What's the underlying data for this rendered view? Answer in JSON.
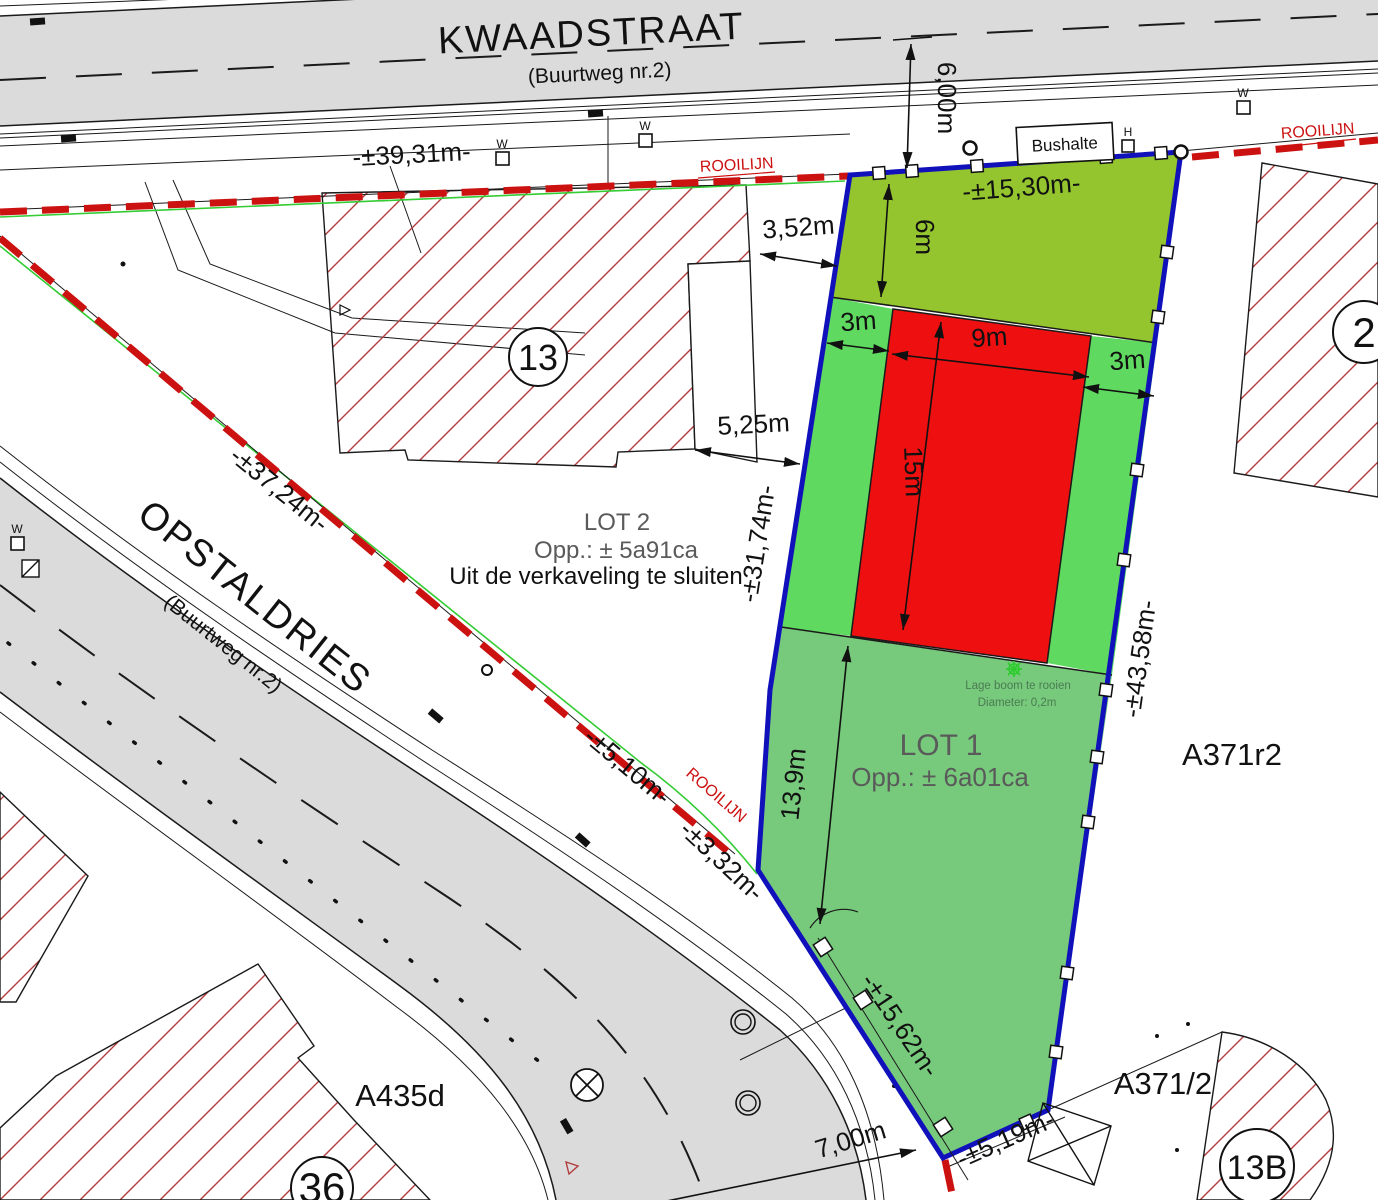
{
  "streets": {
    "kwaadstraat": {
      "name": "KWAADSTRAAT",
      "subtitle": "(Buurtweg nr.2)"
    },
    "opstaldries": {
      "name": "OPSTALDRIES",
      "subtitle": "(Buurtweg nr.2)"
    }
  },
  "lots": {
    "lot1": {
      "title": "LOT 1",
      "area": "Opp.: ± 6a01ca"
    },
    "lot2": {
      "title": "LOT 2",
      "area": "Opp.: ± 5a91ca",
      "note": "Uit de verkaveling te sluiten"
    }
  },
  "dims": {
    "road_top": "6,00m",
    "top_length": "-±39,31m-",
    "front": "-±15,30m-",
    "front_depth": "6m",
    "side_left": "3m",
    "zone_width": "9m",
    "side_right": "3m",
    "zone_depth": "15m",
    "gap_top": "3,52m",
    "gap_mid": "5,25m",
    "left_edge": "-±31,74m-",
    "right_edge": "-±43,58m-",
    "diag_length": "-±37,24m-",
    "seg_a": "-±5,10m-",
    "seg_b": "-±3,32m-",
    "lot1_depth": "13,9m",
    "lower_left": "-±15,62m-",
    "bottom_edge": "-±5,19m-",
    "road_bottom": "7,00m"
  },
  "labels": {
    "rooilijn": "ROOILIJN",
    "bushalte": "Bushalte",
    "w_marker": "W",
    "h_marker": "H"
  },
  "tree": {
    "line1": "Lage boom te rooien",
    "line2": "Diameter: 0,2m"
  },
  "parcels": {
    "house13": "13",
    "house2": "2",
    "house36": "36",
    "house13b": "13B",
    "a371r2": "A371r2",
    "a371_2": "A371/2",
    "a435d": "A435d"
  },
  "colors": {
    "road_gray": "#dbdbdb",
    "rooilijn_red": "#cc1111",
    "rooilijn_green": "#33cc33",
    "lot_border_blue": "#1111bb",
    "front_garden_green": "#94c52f",
    "side_strip_green": "#5fd95f",
    "lot1_green": "#77c97c",
    "building_zone_red": "#ee1010",
    "hatch_red": "#b23b3b"
  }
}
